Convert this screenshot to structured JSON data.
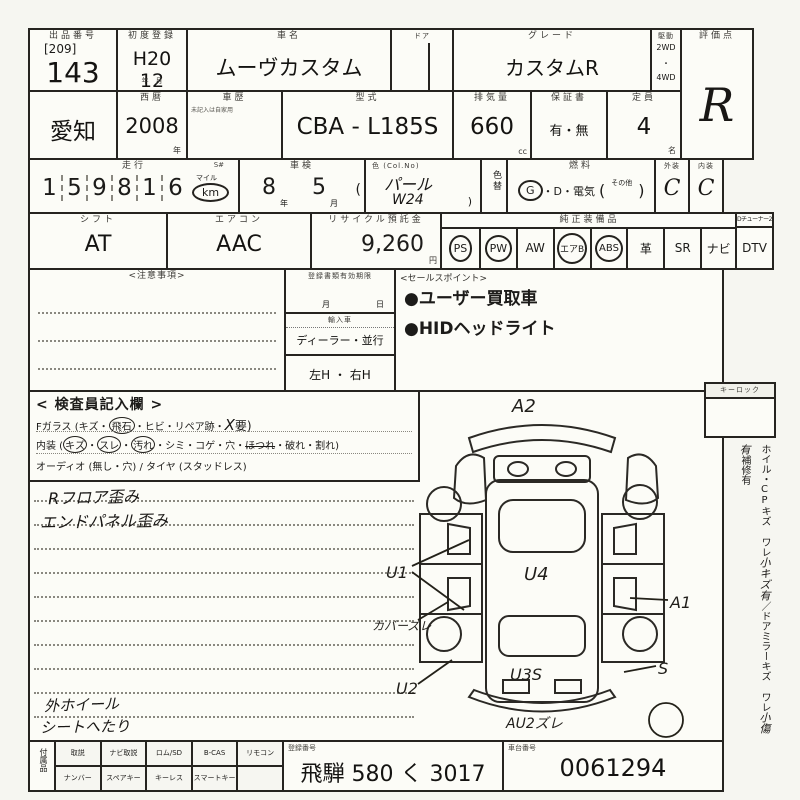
{
  "header": {
    "auction_label": "出品番号",
    "auction_bracket": "[209]",
    "auction_no": "143",
    "firstreg_label": "初度登録",
    "firstreg_value": "H20 12",
    "firstreg_units": "年　月",
    "carname_label": "車名",
    "carname": "ムーヴカスタム",
    "door_label": "ドア",
    "grade_label": "グレード",
    "grade": "カスタムR",
    "drive_label": "駆動",
    "drive_2wd": "2WD",
    "drive_dot": "・",
    "drive_4wd": "4WD",
    "score_label": "評価点",
    "score": "R"
  },
  "row2": {
    "region": "愛知",
    "year_label": "西暦",
    "year": "2008",
    "year_unit": "年",
    "history_label": "車歴",
    "history_note": "未記入は自家用",
    "model_label": "型式",
    "model": "CBA - L185S",
    "cc_label": "排気量",
    "cc": "660",
    "cc_unit": "cc",
    "warranty_label": "保証書",
    "warranty": "有・無",
    "capacity_label": "定員",
    "capacity": "4",
    "capacity_unit": "名"
  },
  "row3": {
    "mileage_label": "走行",
    "s_label": "S#",
    "digits": [
      "1",
      "5",
      "9",
      "8",
      "1",
      "6"
    ],
    "mile_unit": "マイル",
    "km_unit": "km",
    "shaken_label": "車検",
    "shaken_year": "8",
    "shaken_year_unit": "年",
    "shaken_month": "5",
    "shaken_month_unit": "月",
    "shaken_paren": "(",
    "color_label": "色 (Col.No)",
    "color": "パール",
    "color_code": "W24",
    "color_paren": ")",
    "colorchg_label": "色替",
    "fuel_label": "燃料",
    "fuel_g": "G",
    "fuel_rest": "・D・電気",
    "fuel_open": "(",
    "fuel_other": "その他",
    "fuel_close": ")",
    "ext_label": "外装",
    "ext": "C",
    "int_label": "内装",
    "int": "C"
  },
  "row4": {
    "shift_label": "シフト",
    "shift": "AT",
    "aircon_label": "エアコン",
    "aircon": "AAC",
    "recycle_label": "リサイクル預託金",
    "recycle": "9,260",
    "recycle_unit": "円",
    "equip_label": "純正装備品",
    "equip_corner": "Dチューナー2",
    "equip_items": [
      "PS",
      "PW",
      "AW",
      "エアB",
      "ABS",
      "革",
      "SR",
      "ナビ",
      "DTV"
    ]
  },
  "mid": {
    "notes_label": "<注意事項>",
    "docs_label": "登録書類有効期限",
    "docs_month": "月",
    "docs_day": "日",
    "import_label": "輸入車",
    "import_value": "ディーラー・並行",
    "handle_value": "左H ・ 右H",
    "sales_label": "<セールスポイント>",
    "sales_points": [
      "●ユーザー買取車",
      "●HIDヘッドライト"
    ]
  },
  "inspect": {
    "title": "< 検査員記入欄 >",
    "fglass_prefix": "Fガラス (キズ・",
    "fglass_circled": "飛石",
    "fglass_mid": "・ヒビ・リペア跡・",
    "fglass_hw": "X",
    "fglass_suffix": "要)",
    "int_prefix": "内装 (",
    "int_c1": "キズ",
    "dot1": "・",
    "int_c2": "スレ",
    "dot2": "・",
    "int_c3": "汚れ",
    "int_rest": "・シミ・コゲ・穴・",
    "int_struck": "ほつれ",
    "int_tail": "・破れ・割れ)",
    "audio_line": "オーディオ (無し・穴) / タイヤ (スタッドレス)",
    "hw1": "Rフロア歪み",
    "hw2": "エンドパネル歪み",
    "hw3": "外ホイール",
    "hw4": "シートへたり"
  },
  "diagram": {
    "a2": "A2",
    "u1": "U1",
    "cover": "カバーズレ",
    "u2": "U2",
    "u4": "U4",
    "u3s": "U3S",
    "a1": "A1",
    "s": "S",
    "au2": "AU2ズレ"
  },
  "side": {
    "keylock_label": "キーロック",
    "printed1": "ホイル・CPキズ ワレ",
    "hw1": "小キズ有",
    "printed2": "／ドアミラーキズ ワレ",
    "hw2": "小傷有",
    "printed3": "補修有"
  },
  "footer": {
    "accessory_label": "付属品",
    "row1": [
      "取説",
      "ナビ取説",
      "ロム/SD",
      "B-CAS",
      "リモコン"
    ],
    "row2": [
      "ナンバー",
      "スペアキー",
      "キーレス",
      "スマートキー",
      ""
    ],
    "regno_label": "登録番号",
    "regno": "飛騨 580 く 3017",
    "chassis_label": "車台番号",
    "chassis": "0061294"
  }
}
